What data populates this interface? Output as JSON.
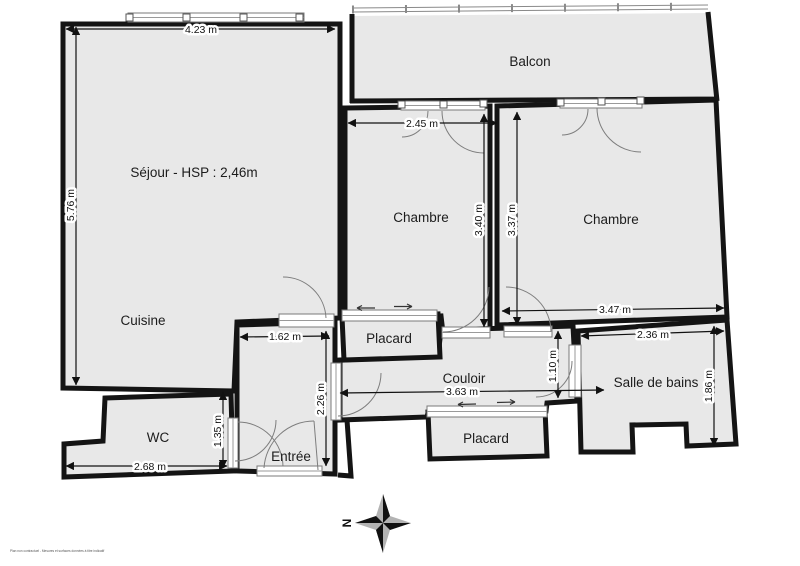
{
  "plan": {
    "rooms": {
      "sejour": "Séjour - HSP : 2,46m",
      "cuisine": "Cuisine",
      "balcon": "Balcon",
      "chambre_left": "Chambre",
      "chambre_right": "Chambre",
      "couloir": "Couloir",
      "salle_de_bains": "Salle de bains",
      "wc": "WC",
      "entree": "Entrée",
      "placard_upper": "Placard",
      "placard_lower": "Placard"
    },
    "dimensions": {
      "sejour_width": "4.23 m",
      "sejour_height": "5.76 m",
      "chambre_left_width": "2.45 m",
      "chambre_left_depth": "3.40 m",
      "chambre_right_depth": "3.37 m",
      "chambre_right_width": "3.47 m",
      "entree_width": "1.62 m",
      "entree_depth": "2.26 m",
      "couloir_length": "3.63 m",
      "couloir_end_width": "1.10 m",
      "bathroom_width": "2.36 m",
      "bathroom_depth": "1.86 m",
      "wc_width": "2.68 m",
      "wc_depth": "1.35 m"
    },
    "compass": {
      "north": "N"
    },
    "fine_print": "Plan non contractuel - Mesures et surfaces données à titre indicatif",
    "colors": {
      "floor": "#e8e8e8",
      "wall": "#141414",
      "background": "#ffffff",
      "railing": "#8a8a8a"
    }
  }
}
